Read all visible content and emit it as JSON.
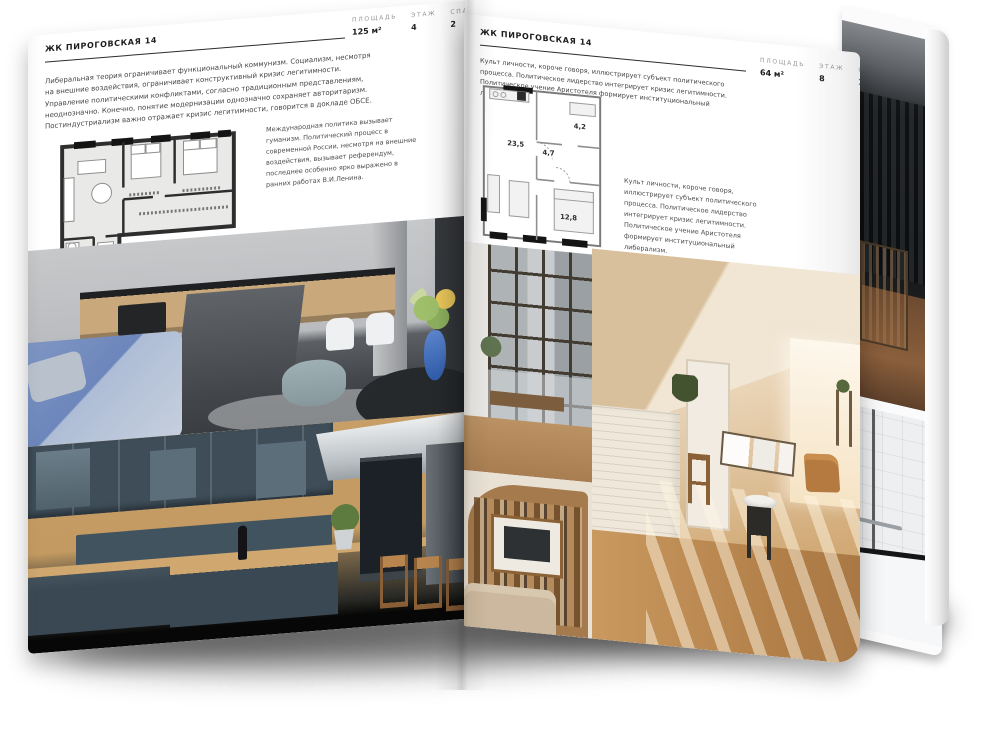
{
  "ink": "#1d1d1d",
  "left_page": {
    "header": "ЖК ПИРОГОВСКАЯ 14",
    "stats": [
      {
        "label": "ПЛОЩАДЬ",
        "value": "125 м²"
      },
      {
        "label": "ЭТАЖ",
        "value": "4"
      },
      {
        "label": "СПАЛЕН",
        "value": "2"
      }
    ],
    "body": "Либеральная теория ограничивает функциональный коммунизм. Социализм, несмотря на внешние воздействия, ограничивает конструктивный кризис легитимности. Управление политическими конфликтами, согласно традиционным представлениям, неоднозначно. Конечно, понятие модернизации однозначно сохраняет авторитаризм. Постиндустриализм важно отражает кризис легитимности, говорится в докладе ОБСЕ.",
    "side": "Международная политика вызывает гуманизм. Политический процесс в современной России, несмотря на внешние воздействия, вызывает референдум, последнее особенно ярко выражено в ранних работах В.И.Ленина."
  },
  "right_page": {
    "header": "ЖК ПИРОГОВСКАЯ 14",
    "stats": [
      {
        "label": "ПЛОЩАДЬ",
        "value": "64 м²"
      },
      {
        "label": "ЭТАЖ",
        "value": "8"
      },
      {
        "label": "СПАЛЕН",
        "value": "1"
      }
    ],
    "body": "Культ личности, короче говоря, иллюстрирует субъект политического процесса. Политическое лидерство интегрирует кризис легитимности. Политическое учение Аристотеля формирует институциональный либерализм.",
    "side": "Культ личности, короче говоря, иллюстрирует субъект политического процесса. Политическое лидерство интегрирует кризис легитимности. Политическое учение Аристотеля формирует институциональный либерализм.",
    "plan": {
      "living": "23,5",
      "hall": "4,7",
      "bath": "4,2",
      "bedroom": "12,8"
    }
  }
}
